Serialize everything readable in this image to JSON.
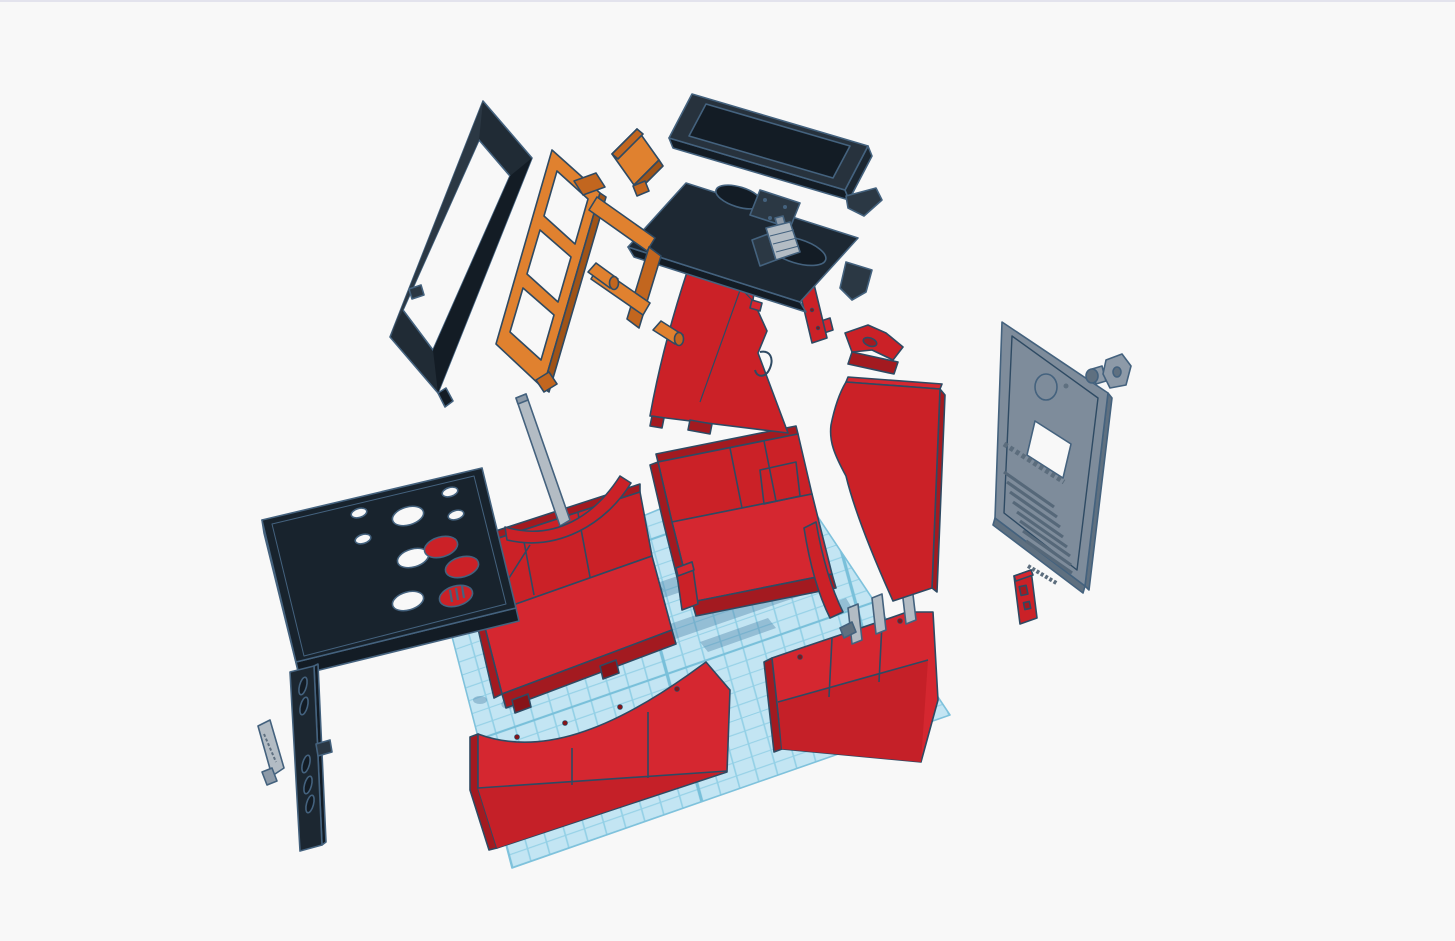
{
  "app": {
    "type": "3d-design-viewport",
    "content": "exploded arcade cabinet model"
  },
  "canvas": {
    "width": 1455,
    "height": 941,
    "background": "#f8f8f8",
    "top_border": "#e3e3ed"
  },
  "palette": {
    "outline": "#44627e",
    "outline_dark": "#2e4a63",
    "dark": "#1c2731",
    "dark_light": "#2b3844",
    "dark_deep": "#131c25",
    "red": "#cb2127",
    "red_bright": "#d52730",
    "red_band": "#c52028",
    "red_dark": "#a31a20",
    "red_deep": "#871318",
    "orange": "#e0812f",
    "orange_dark": "#c2661f",
    "orange_deep": "#9f5317",
    "gray": "#7e8c9b",
    "gray_dark": "#5f7080",
    "gray_mid": "#8d9aa8",
    "gray_light": "#b3bcc4",
    "hole": "#f8f8f8",
    "slat": "#566879",
    "slat_light": "#9aa7b4",
    "emboss": "#5c6d7d",
    "grid_fill": "#c3e5f3",
    "grid_line": "#93d0e6",
    "grid_major": "#79c0da",
    "grid_border": "#7fc2dc",
    "shadow": "rgba(70,125,165,0.38)"
  },
  "workplane": {
    "label": "workplane-grid"
  },
  "parts": {
    "bezel_frame": {
      "label": "screen bezel frame",
      "color": "#202b35"
    },
    "monitor_stand": {
      "label": "monitor stand frame",
      "color": "#e0812f"
    },
    "stand_plate": {
      "label": "stand mounting plate",
      "color": "#e0812f"
    },
    "monitor": {
      "label": "monitor panel",
      "color": "#27323d"
    },
    "speaker_panel": {
      "label": "speaker panel",
      "color": "#1d2833"
    },
    "side_panel_left": {
      "label": "cabinet side panel left",
      "color": "#cb2127"
    },
    "side_panel_right": {
      "label": "cabinet side panel right",
      "color": "#cb2127"
    },
    "spine": {
      "label": "side support spine",
      "color": "#cb2127"
    },
    "side_sliver": {
      "label": "curved side strip",
      "color": "#cb2127"
    },
    "control_deck": {
      "label": "control panel deck",
      "color": "#18232d"
    },
    "front_panel": {
      "label": "control front panel",
      "color": "#1c2731"
    },
    "gray_strip": {
      "label": "trim strip",
      "color": "#b3bcc4"
    },
    "back_door": {
      "label": "back door panel",
      "color": "#7e8c9b"
    },
    "lock_knob": {
      "label": "lock knob",
      "color": "#8d9aa8"
    },
    "coin_block": {
      "label": "coin slot block",
      "color": "#cb2127"
    },
    "base_box_left": {
      "label": "cabinet base section left",
      "color": "#cb2127"
    },
    "base_box_right": {
      "label": "cabinet base section right",
      "color": "#cb2127"
    },
    "back_curve": {
      "label": "curved back panel",
      "color": "#cb2127"
    },
    "red_peg": {
      "label": "red alignment peg",
      "color": "#cb2127"
    },
    "skirt_left": {
      "label": "front skirt panel left",
      "color": "#d52730"
    },
    "skirt_right": {
      "label": "front skirt panel right",
      "color": "#d52730"
    },
    "strut": {
      "label": "support strut",
      "color": "#b3bcc4"
    },
    "mount_bracket": {
      "label": "monitor mount bracket",
      "color": "#b3bcc4"
    },
    "pegs": {
      "label": "alignment pegs",
      "color": "#b3bcc4"
    }
  }
}
